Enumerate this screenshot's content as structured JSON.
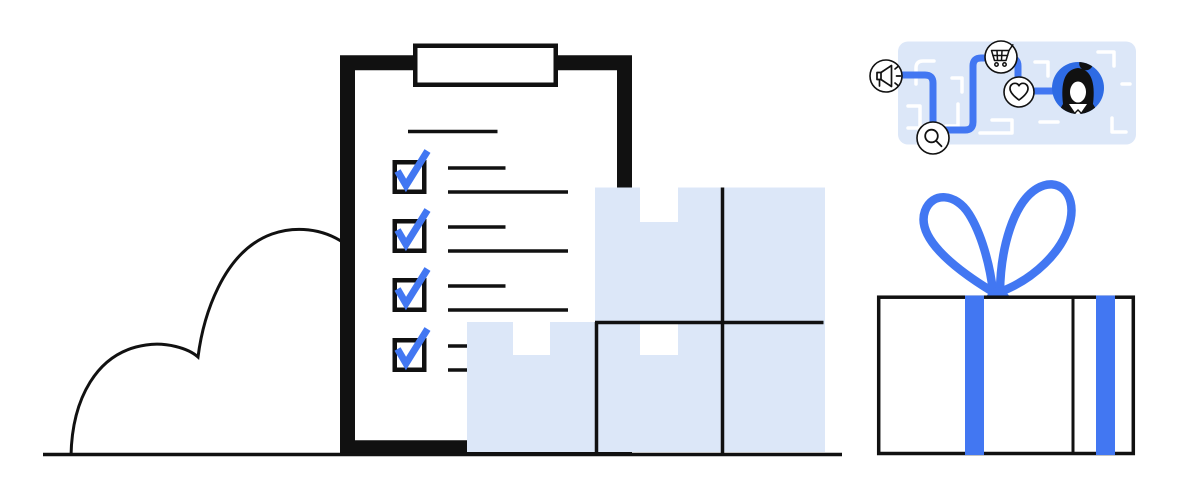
{
  "illustration": {
    "description": "Flat vector illustration: clipboard with completed checklist, stacked delivery packages, a cloud, a customer journey map with touchpoint icons, and a gift box with blue ribbon",
    "colors": {
      "accent_blue": "#4277f2",
      "avatar_blue": "#2e6be4",
      "panel_blue": "#dce7f8",
      "ink": "#111111",
      "background": "#ffffff"
    },
    "clipboard": {
      "checklist": {
        "items": [
          {
            "checked": true,
            "lines": 2
          },
          {
            "checked": true,
            "lines": 2
          },
          {
            "checked": true,
            "lines": 2
          },
          {
            "checked": false,
            "lines": 0
          }
        ]
      }
    },
    "journey_map": {
      "stops": [
        {
          "icon": "megaphone-icon"
        },
        {
          "icon": "search-icon"
        },
        {
          "icon": "cart-icon"
        },
        {
          "icon": "heart-icon"
        },
        {
          "icon": "customer-avatar"
        }
      ]
    },
    "packages": {
      "count": 5
    },
    "gift": {
      "ribbon_color": "#4277f2"
    }
  }
}
